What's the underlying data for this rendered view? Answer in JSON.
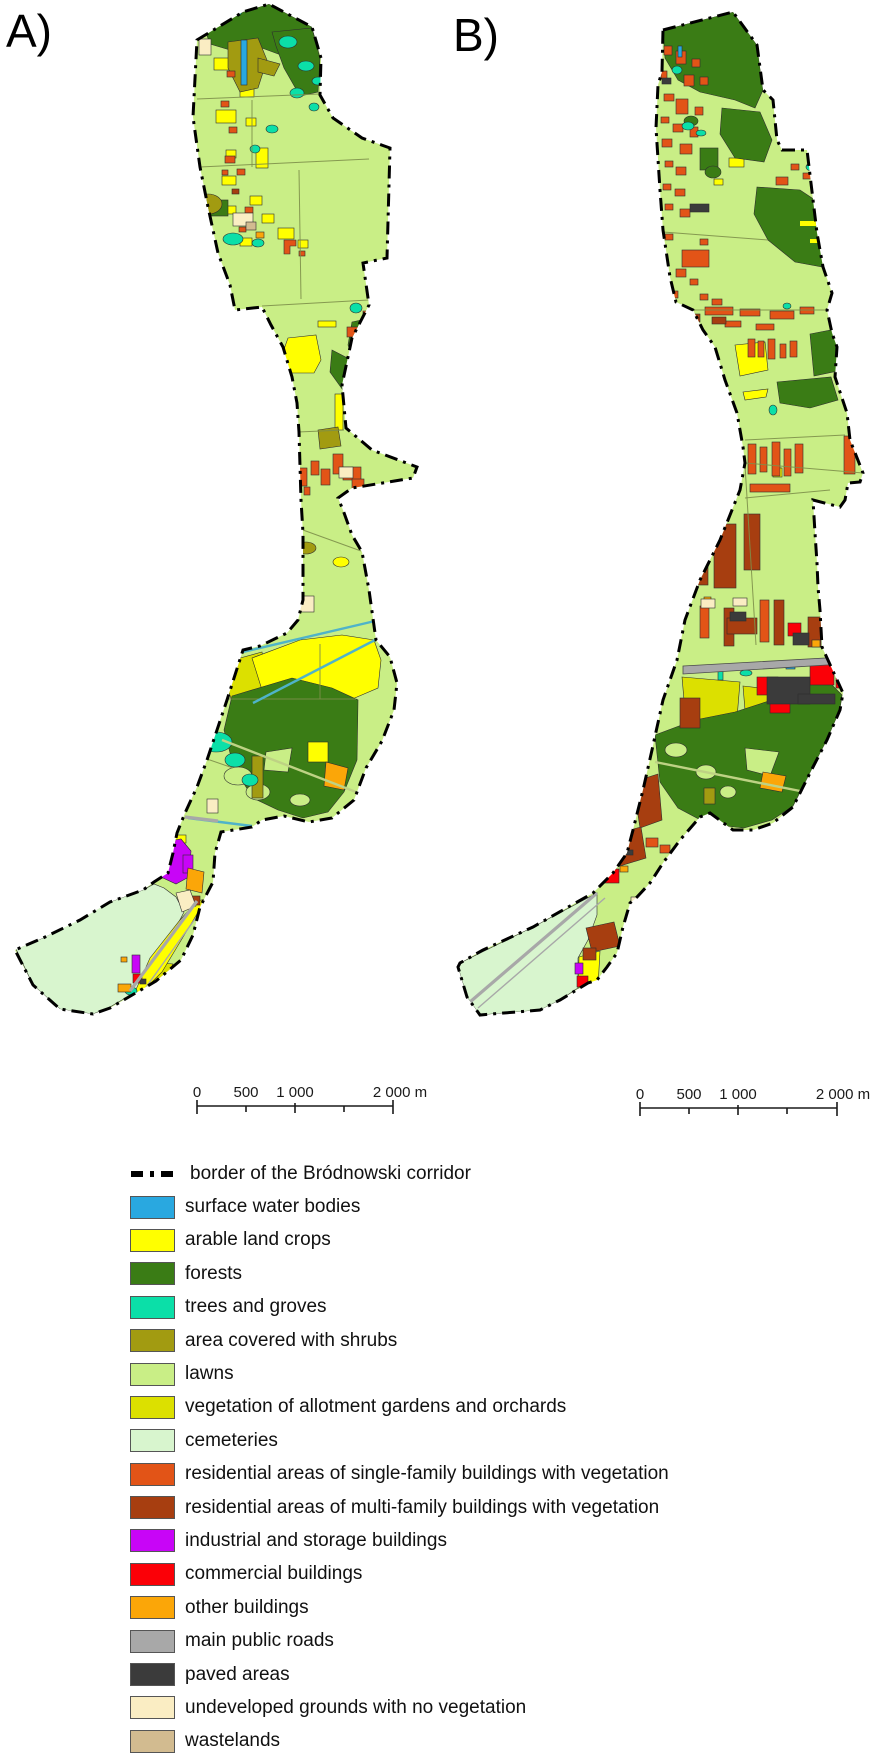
{
  "panels": [
    {
      "id": "A",
      "label": "A)"
    },
    {
      "id": "B",
      "label": "B)"
    }
  ],
  "scalebar": {
    "t0": "0",
    "t500": "500",
    "t1000": "1 000",
    "t2000": "2 000 m"
  },
  "legend": {
    "items": [
      {
        "key": "border",
        "type": "line",
        "color": "#000000",
        "label": "border of the Bródnowski corridor"
      },
      {
        "key": "water",
        "type": "fill",
        "color": "#29A8E0",
        "label": "surface water bodies"
      },
      {
        "key": "arable",
        "type": "fill",
        "color": "#FFFF00",
        "label": "arable land crops"
      },
      {
        "key": "forest",
        "type": "fill",
        "color": "#3A7C15",
        "label": "forests"
      },
      {
        "key": "trees",
        "type": "fill",
        "color": "#0BDFA8",
        "label": "trees and groves"
      },
      {
        "key": "shrubs",
        "type": "fill",
        "color": "#A29B11",
        "label": "area covered with shrubs"
      },
      {
        "key": "lawns",
        "type": "fill",
        "color": "#C9EE86",
        "label": "lawns"
      },
      {
        "key": "allotment",
        "type": "fill",
        "color": "#DCE000",
        "label": "vegetation of allotment gardens and orchards"
      },
      {
        "key": "cemetery",
        "type": "fill",
        "color": "#D8F5CE",
        "label": "cemeteries"
      },
      {
        "key": "single_family",
        "type": "fill",
        "color": "#E25417",
        "label": "residential areas of single-family buildings with vegetation"
      },
      {
        "key": "multi_family",
        "type": "fill",
        "color": "#A73E10",
        "label": "residential areas of multi-family buildings with vegetation"
      },
      {
        "key": "industrial",
        "type": "fill",
        "color": "#C805F7",
        "label": "industrial and storage buildings"
      },
      {
        "key": "commercial",
        "type": "fill",
        "color": "#FB0007",
        "label": "commercial buildings"
      },
      {
        "key": "other_buildings",
        "type": "fill",
        "color": "#FBA608",
        "label": "other buildings"
      },
      {
        "key": "roads",
        "type": "fill",
        "color": "#A8A8A8",
        "label": "main public roads"
      },
      {
        "key": "paved",
        "type": "fill",
        "color": "#3B3B3B",
        "label": "paved areas"
      },
      {
        "key": "undeveloped",
        "type": "fill",
        "color": "#FAEDC3",
        "label": "undeveloped grounds with no vegetation"
      },
      {
        "key": "wastelands",
        "type": "fill",
        "color": "#D2BB90",
        "label": "wastelands"
      }
    ]
  }
}
